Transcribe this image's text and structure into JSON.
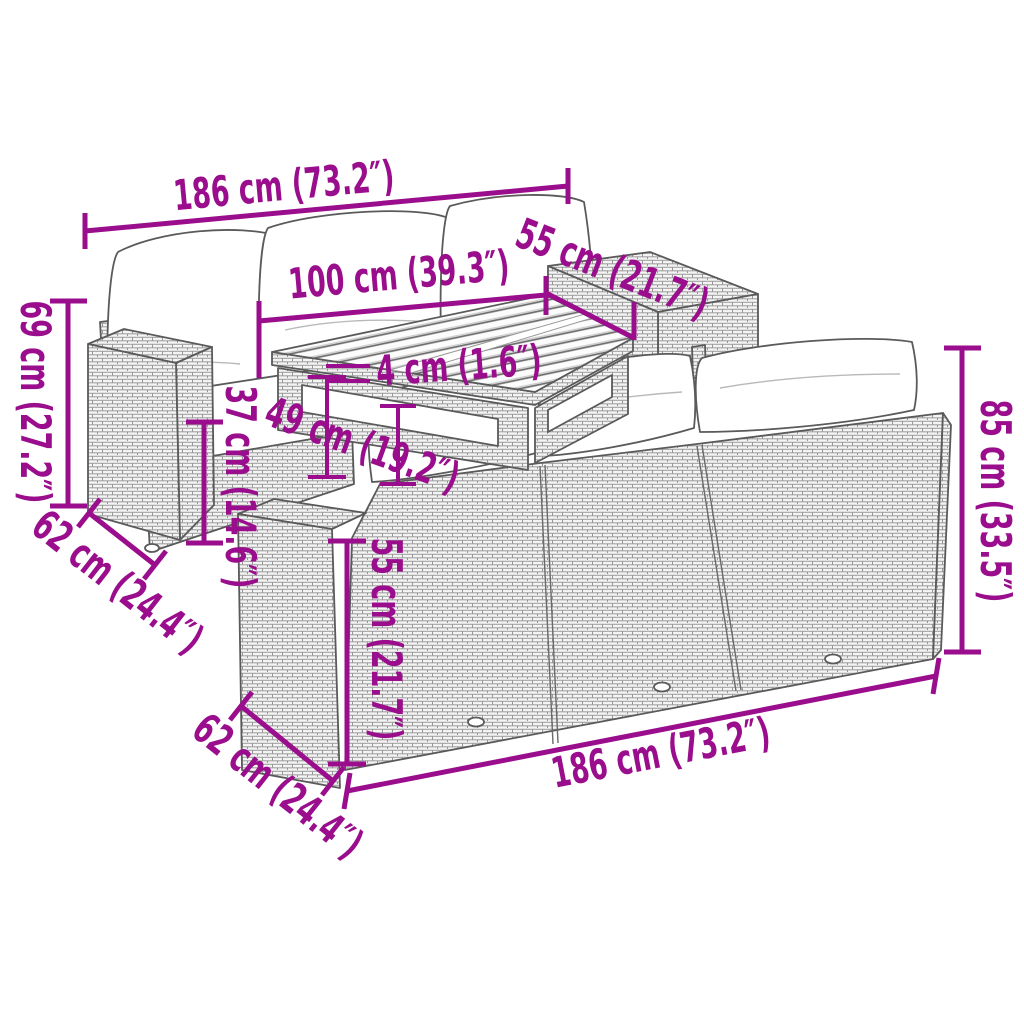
{
  "diagram": {
    "type": "product-dimension-diagram",
    "product": "rattan-garden-lounge-set",
    "background_color": "#ffffff",
    "accent_color": "#9a0d8c",
    "furniture_line_color": "#5a5a5a",
    "cushion_color": "#ffffff",
    "dimensions": [
      {
        "id": "back-sofa-top-width",
        "label": "186 cm (73.2″)"
      },
      {
        "id": "table-top-depth",
        "label": "55 cm (21.7″)"
      },
      {
        "id": "table-top-width",
        "label": "100 cm (39.3″)"
      },
      {
        "id": "table-top-thickness",
        "label": "4 cm (1.6″)"
      },
      {
        "id": "table-height",
        "label": "49 cm (19.2″)"
      },
      {
        "id": "back-sofa-height",
        "label": "69 cm (27.2″)"
      },
      {
        "id": "seat-height",
        "label": "37 cm (14.6″)"
      },
      {
        "id": "back-sofa-depth",
        "label": "62 cm (24.4″)"
      },
      {
        "id": "front-sofa-side-height",
        "label": "55 cm (21.7″)"
      },
      {
        "id": "front-sofa-height",
        "label": "85 cm (33.5″)"
      },
      {
        "id": "front-sofa-depth",
        "label": "62 cm (24.4″)"
      },
      {
        "id": "front-sofa-width",
        "label": "186 cm (73.2″)"
      }
    ]
  }
}
